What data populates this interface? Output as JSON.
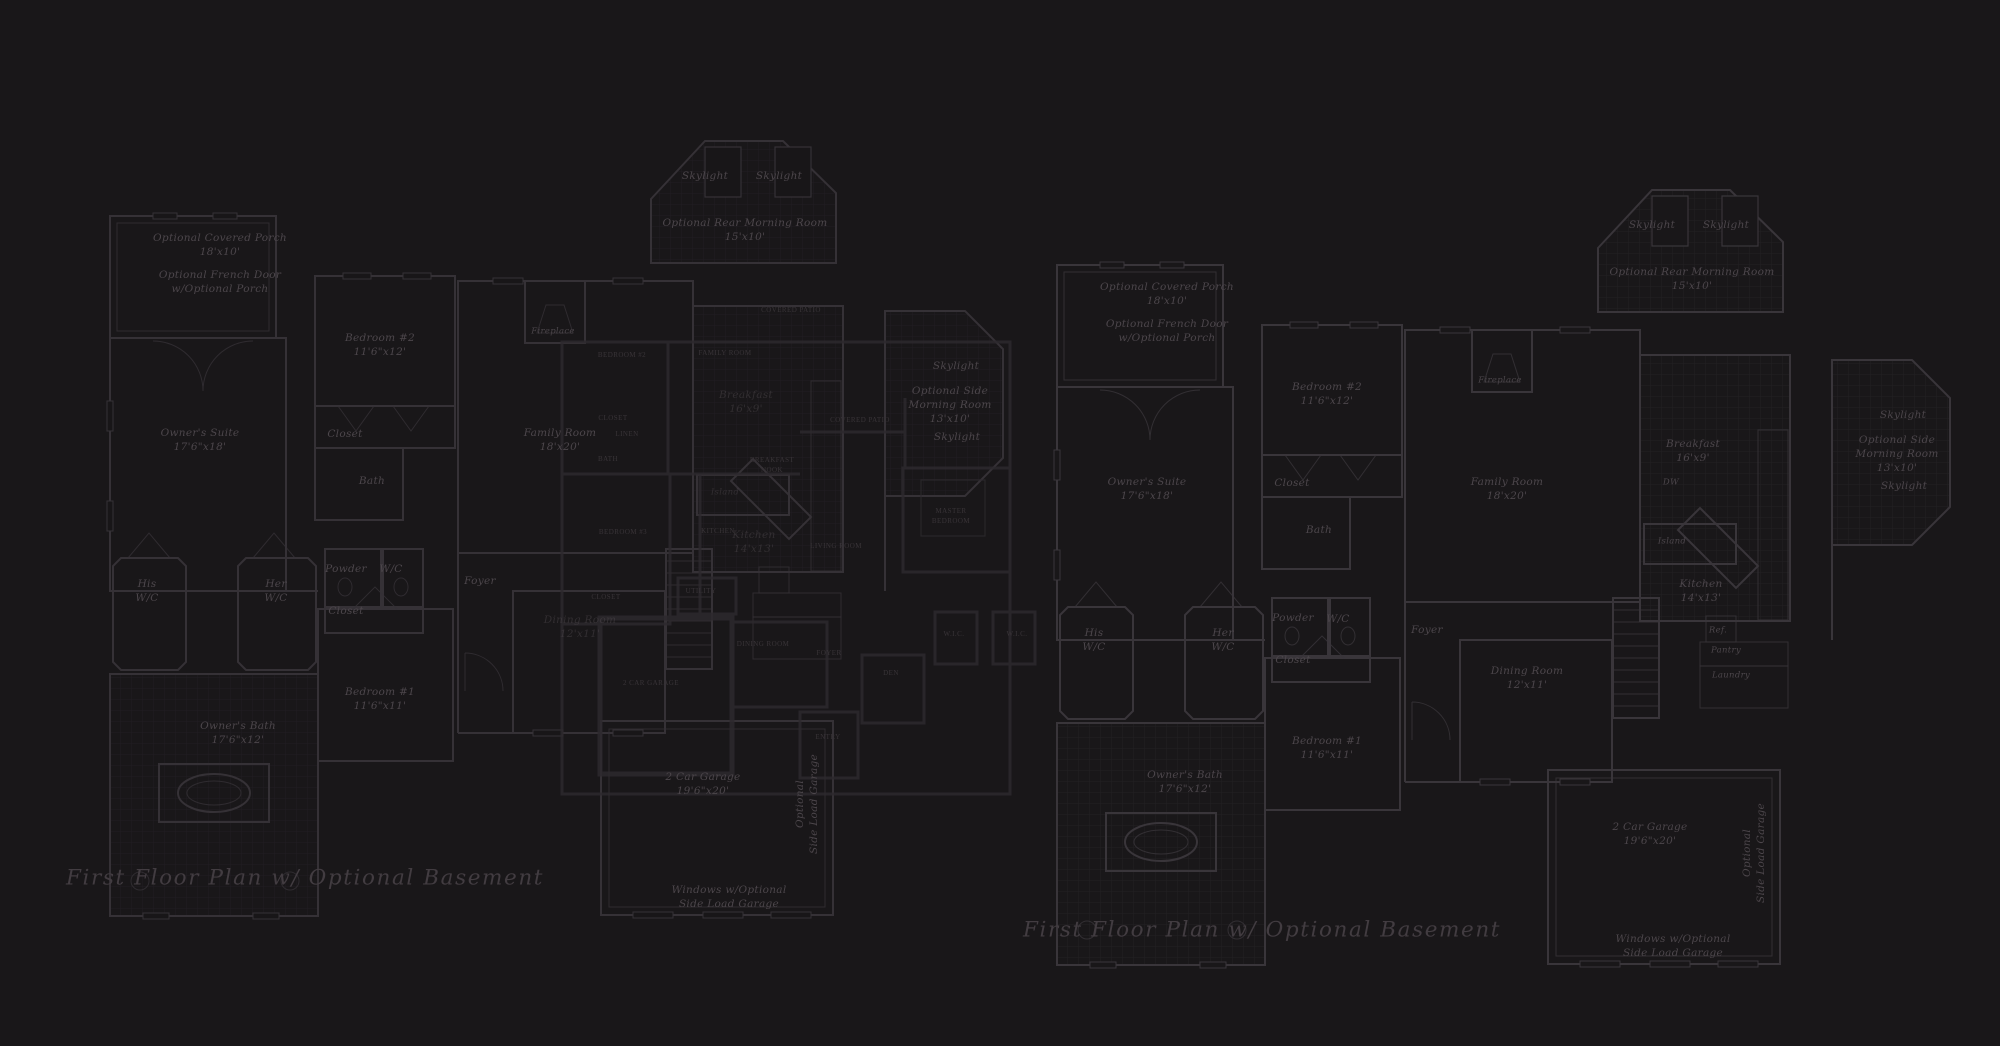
{
  "colors": {
    "background": "#191719",
    "main_plan_lines": "#39353a",
    "detail_plan_lines": "#2d2a2e",
    "tile_grid_lines": "#232024",
    "label_ink": "#4c464b",
    "detail_label_ink": "#393438",
    "title_ink": "#423c41"
  },
  "plans": {
    "left": {
      "title": "First Floor Plan  w/ Optional Basement",
      "labels": [
        {
          "name": "optional-covered-porch-label",
          "x": 220,
          "y": 246,
          "cls": "",
          "text": "Optional Covered Porch\n18'x10'"
        },
        {
          "name": "optional-french-door-note",
          "x": 220,
          "y": 283,
          "cls": "",
          "text": "Optional French Door\nw/Optional Porch"
        },
        {
          "name": "bedroom-2-label",
          "x": 380,
          "y": 346,
          "cls": "",
          "text": "Bedroom #2\n11'6\"x12'"
        },
        {
          "name": "closet-label",
          "x": 345,
          "y": 435,
          "cls": "",
          "text": "Closet"
        },
        {
          "name": "bath-label",
          "x": 372,
          "y": 482,
          "cls": "",
          "text": "Bath"
        },
        {
          "name": "owners-suite-label",
          "x": 200,
          "y": 441,
          "cls": "",
          "text": "Owner's Suite\n17'6\"x18'"
        },
        {
          "name": "his-wc-label",
          "x": 147,
          "y": 592,
          "cls": "",
          "text": "His\nW/C"
        },
        {
          "name": "her-wc-label",
          "x": 276,
          "y": 592,
          "cls": "",
          "text": "Her\nW/C"
        },
        {
          "name": "powder-label",
          "x": 346,
          "y": 570,
          "cls": "",
          "text": "Powder"
        },
        {
          "name": "wc-label",
          "x": 391,
          "y": 570,
          "cls": "",
          "text": "W/C"
        },
        {
          "name": "closet-2-label",
          "x": 346,
          "y": 612,
          "cls": "",
          "text": "Closet"
        },
        {
          "name": "foyer-label",
          "x": 480,
          "y": 582,
          "cls": "",
          "text": "Foyer"
        },
        {
          "name": "bedroom-1-label",
          "x": 380,
          "y": 700,
          "cls": "",
          "text": "Bedroom #1\n11'6\"x11'"
        },
        {
          "name": "owners-bath-label",
          "x": 238,
          "y": 734,
          "cls": "",
          "text": "Owner's Bath\n17'6\"x12'"
        },
        {
          "name": "family-room-label",
          "x": 560,
          "y": 441,
          "cls": "",
          "text": "Family Room\n18'x20'"
        },
        {
          "name": "fireplace-label",
          "x": 553,
          "y": 332,
          "cls": "sm",
          "text": "Fireplace"
        },
        {
          "name": "skylight-label",
          "x": 705,
          "y": 177,
          "cls": "",
          "text": "Skylight"
        },
        {
          "name": "skylight-label",
          "x": 779,
          "y": 177,
          "cls": "",
          "text": "Skylight"
        },
        {
          "name": "rear-morning-room-label",
          "x": 745,
          "y": 231,
          "cls": "",
          "text": "Optional Rear Morning Room\n15'x10'"
        },
        {
          "name": "dining-room-label",
          "x": 580,
          "y": 628,
          "cls": "dim",
          "text": "Dining Room\n12'x11'"
        },
        {
          "name": "breakfast-label",
          "x": 746,
          "y": 403,
          "cls": "dim",
          "text": "Breakfast\n16'x9'"
        },
        {
          "name": "island-label",
          "x": 725,
          "y": 493,
          "cls": "dim sm",
          "text": "Island"
        },
        {
          "name": "kitchen-label",
          "x": 754,
          "y": 543,
          "cls": "dim",
          "text": "Kitchen\n14'x13'"
        },
        {
          "name": "skylight-label",
          "x": 956,
          "y": 367,
          "cls": "",
          "text": "Skylight"
        },
        {
          "name": "side-morning-room-label",
          "x": 950,
          "y": 406,
          "cls": "",
          "text": "Optional Side\nMorning Room\n13'x10'"
        },
        {
          "name": "skylight-label",
          "x": 957,
          "y": 438,
          "cls": "",
          "text": "Skylight"
        },
        {
          "name": "garage-label",
          "x": 703,
          "y": 785,
          "cls": "",
          "text": "2 Car Garage\n19'6\"x20'"
        },
        {
          "name": "optional-side-load-garage-label",
          "x": 808,
          "y": 804,
          "cls": "vert",
          "text": "Optional\nSide Load Garage"
        },
        {
          "name": "windows-note",
          "x": 729,
          "y": 898,
          "cls": "",
          "text": "Windows w/Optional\nSide Load Garage"
        }
      ]
    },
    "right": {
      "title": "First Floor Plan  w/ Optional Basement",
      "labels": [
        {
          "name": "optional-covered-porch-label",
          "x": 1167,
          "y": 295,
          "cls": "",
          "text": "Optional Covered Porch\n18'x10'"
        },
        {
          "name": "optional-french-door-note",
          "x": 1167,
          "y": 332,
          "cls": "",
          "text": "Optional French Door\nw/Optional Porch"
        },
        {
          "name": "bedroom-2-label",
          "x": 1327,
          "y": 395,
          "cls": "",
          "text": "Bedroom #2\n11'6\"x12'"
        },
        {
          "name": "closet-label",
          "x": 1292,
          "y": 484,
          "cls": "",
          "text": "Closet"
        },
        {
          "name": "bath-label",
          "x": 1319,
          "y": 531,
          "cls": "",
          "text": "Bath"
        },
        {
          "name": "owners-suite-label",
          "x": 1147,
          "y": 490,
          "cls": "",
          "text": "Owner's Suite\n17'6\"x18'"
        },
        {
          "name": "his-wc-label",
          "x": 1094,
          "y": 641,
          "cls": "",
          "text": "His\nW/C"
        },
        {
          "name": "her-wc-label",
          "x": 1223,
          "y": 641,
          "cls": "",
          "text": "Her\nW/C"
        },
        {
          "name": "powder-label",
          "x": 1293,
          "y": 619,
          "cls": "",
          "text": "Powder"
        },
        {
          "name": "wc-label",
          "x": 1338,
          "y": 620,
          "cls": "",
          "text": "W/C"
        },
        {
          "name": "closet-2-label",
          "x": 1293,
          "y": 661,
          "cls": "",
          "text": "Closet"
        },
        {
          "name": "foyer-label",
          "x": 1427,
          "y": 631,
          "cls": "",
          "text": "Foyer"
        },
        {
          "name": "bedroom-1-label",
          "x": 1327,
          "y": 749,
          "cls": "",
          "text": "Bedroom #1\n11'6\"x11'"
        },
        {
          "name": "owners-bath-label",
          "x": 1185,
          "y": 783,
          "cls": "",
          "text": "Owner's Bath\n17'6\"x12'"
        },
        {
          "name": "family-room-label",
          "x": 1507,
          "y": 490,
          "cls": "",
          "text": "Family Room\n18'x20'"
        },
        {
          "name": "fireplace-label",
          "x": 1500,
          "y": 381,
          "cls": "sm",
          "text": "Fireplace"
        },
        {
          "name": "skylight-label",
          "x": 1652,
          "y": 226,
          "cls": "",
          "text": "Skylight"
        },
        {
          "name": "skylight-label",
          "x": 1726,
          "y": 226,
          "cls": "",
          "text": "Skylight"
        },
        {
          "name": "rear-morning-room-label",
          "x": 1692,
          "y": 280,
          "cls": "",
          "text": "Optional Rear Morning Room\n15'x10'"
        },
        {
          "name": "breakfast-label",
          "x": 1693,
          "y": 452,
          "cls": "",
          "text": "Breakfast\n16'x9'"
        },
        {
          "name": "dw-label",
          "x": 1671,
          "y": 483,
          "cls": "sm",
          "text": "DW"
        },
        {
          "name": "island-label",
          "x": 1672,
          "y": 542,
          "cls": "sm",
          "text": "Island"
        },
        {
          "name": "kitchen-label",
          "x": 1701,
          "y": 592,
          "cls": "",
          "text": "Kitchen\n14'x13'"
        },
        {
          "name": "ref-label",
          "x": 1718,
          "y": 631,
          "cls": "sm",
          "text": "Ref."
        },
        {
          "name": "pantry-label",
          "x": 1726,
          "y": 651,
          "cls": "sm",
          "text": "Pantry"
        },
        {
          "name": "laundry-label",
          "x": 1731,
          "y": 676,
          "cls": "sm",
          "text": "Laundry"
        },
        {
          "name": "dining-room-label",
          "x": 1527,
          "y": 679,
          "cls": "",
          "text": "Dining Room\n12'x11'"
        },
        {
          "name": "skylight-label",
          "x": 1903,
          "y": 416,
          "cls": "",
          "text": "Skylight"
        },
        {
          "name": "side-morning-room-label",
          "x": 1897,
          "y": 455,
          "cls": "",
          "text": "Optional Side\nMorning Room\n13'x10'"
        },
        {
          "name": "skylight-label",
          "x": 1904,
          "y": 487,
          "cls": "",
          "text": "Skylight"
        },
        {
          "name": "garage-label",
          "x": 1650,
          "y": 835,
          "cls": "",
          "text": "2 Car Garage\n19'6\"x20'"
        },
        {
          "name": "optional-side-load-garage-label",
          "x": 1755,
          "y": 853,
          "cls": "vert",
          "text": "Optional\nSide Load Garage"
        },
        {
          "name": "windows-note",
          "x": 1673,
          "y": 947,
          "cls": "",
          "text": "Windows w/Optional\nSide Load Garage"
        }
      ]
    },
    "detail_overlay": {
      "labels": [
        {
          "name": "bedroom-2-label",
          "x": 622,
          "y": 356,
          "cls": "caps",
          "text": "BEDROOM #2"
        },
        {
          "name": "family-room-label",
          "x": 725,
          "y": 354,
          "cls": "caps",
          "text": "FAMILY ROOM"
        },
        {
          "name": "closet-label",
          "x": 613,
          "y": 419,
          "cls": "caps",
          "text": "CLOSET"
        },
        {
          "name": "linen-label",
          "x": 627,
          "y": 435,
          "cls": "caps",
          "text": "LINEN"
        },
        {
          "name": "bath-label",
          "x": 608,
          "y": 460,
          "cls": "caps",
          "text": "BATH"
        },
        {
          "name": "bedroom-3-label",
          "x": 623,
          "y": 533,
          "cls": "caps",
          "text": "BEDROOM #3"
        },
        {
          "name": "kitchen-label",
          "x": 718,
          "y": 532,
          "cls": "caps",
          "text": "KITCHEN"
        },
        {
          "name": "breakfast-nook-label",
          "x": 772,
          "y": 466,
          "cls": "caps",
          "text": "BREAKFAST\nNOOK"
        },
        {
          "name": "living-room-label",
          "x": 836,
          "y": 547,
          "cls": "caps",
          "text": "LIVING ROOM"
        },
        {
          "name": "utility-label",
          "x": 701,
          "y": 592,
          "cls": "caps",
          "text": "UTILITY"
        },
        {
          "name": "closet-2-label",
          "x": 606,
          "y": 598,
          "cls": "caps",
          "text": "CLOSET"
        },
        {
          "name": "dining-room-label",
          "x": 763,
          "y": 645,
          "cls": "caps",
          "text": "DINING ROOM"
        },
        {
          "name": "foyer-label",
          "x": 829,
          "y": 654,
          "cls": "caps",
          "text": "FOYER"
        },
        {
          "name": "den-label",
          "x": 891,
          "y": 674,
          "cls": "caps",
          "text": "DEN"
        },
        {
          "name": "entry-label",
          "x": 828,
          "y": 738,
          "cls": "caps",
          "text": "ENTRY"
        },
        {
          "name": "garage-label",
          "x": 651,
          "y": 684,
          "cls": "caps",
          "text": "2 CAR GARAGE"
        },
        {
          "name": "master-bedroom-label",
          "x": 951,
          "y": 517,
          "cls": "caps",
          "text": "MASTER\nBEDROOM"
        },
        {
          "name": "wic-label",
          "x": 954,
          "y": 635,
          "cls": "caps",
          "text": "W.I.C."
        },
        {
          "name": "wic-label",
          "x": 1017,
          "y": 635,
          "cls": "caps",
          "text": "W.I.C."
        },
        {
          "name": "covered-patio-label",
          "x": 860,
          "y": 421,
          "cls": "caps",
          "text": "COVERED PATIO"
        },
        {
          "name": "covered-patio-label",
          "x": 791,
          "y": 311,
          "cls": "caps",
          "text": "COVERED PATIO"
        }
      ]
    }
  }
}
